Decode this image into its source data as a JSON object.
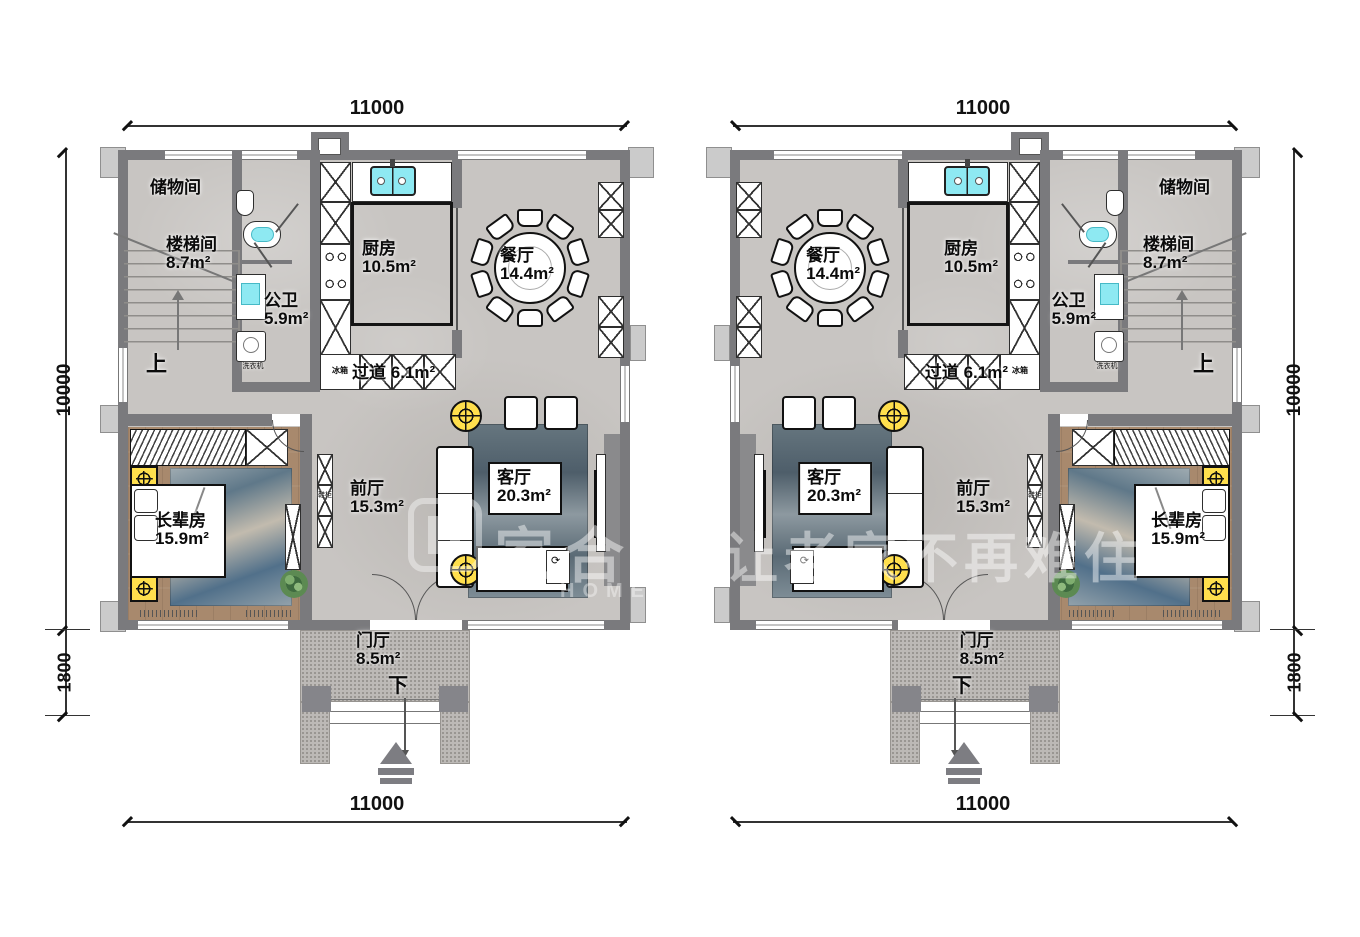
{
  "dimensions": {
    "width_top": "11000",
    "width_bottom": "11000",
    "height_main": "10000",
    "height_porch": "1800"
  },
  "rooms": {
    "storage": {
      "name": "储物间",
      "area": ""
    },
    "stairwell": {
      "name": "楼梯间",
      "area": "8.7m²"
    },
    "bathroom": {
      "name": "公卫",
      "area": "5.9m²"
    },
    "kitchen": {
      "name": "厨房",
      "area": "10.5m²"
    },
    "dining": {
      "name": "餐厅",
      "area": "14.4m²"
    },
    "corridor": {
      "name": "过道",
      "area": "6.1m²"
    },
    "elder_room": {
      "name": "长辈房",
      "area": "15.9m²"
    },
    "front_hall": {
      "name": "前厅",
      "area": "15.3m²"
    },
    "living": {
      "name": "客厅",
      "area": "20.3m²"
    },
    "foyer": {
      "name": "门厅",
      "area": "8.5m²"
    }
  },
  "markers": {
    "up": "上",
    "down": "下"
  },
  "appliances": {
    "fridge": "冰箱",
    "washer": "洗衣机",
    "shoe_cabinet": "鞋柜"
  },
  "watermark": {
    "brand": "家合美",
    "slogan": "让老家不再难住",
    "latin": "HOME M"
  },
  "colors": {
    "wall": "#7a7a7d",
    "floor": "#c8c5c2",
    "wood_floor": "#a8896d",
    "accent_yellow": "#ffdf4d",
    "water_cyan": "#8ee9f2",
    "rug_blue": "#5b6b77"
  }
}
